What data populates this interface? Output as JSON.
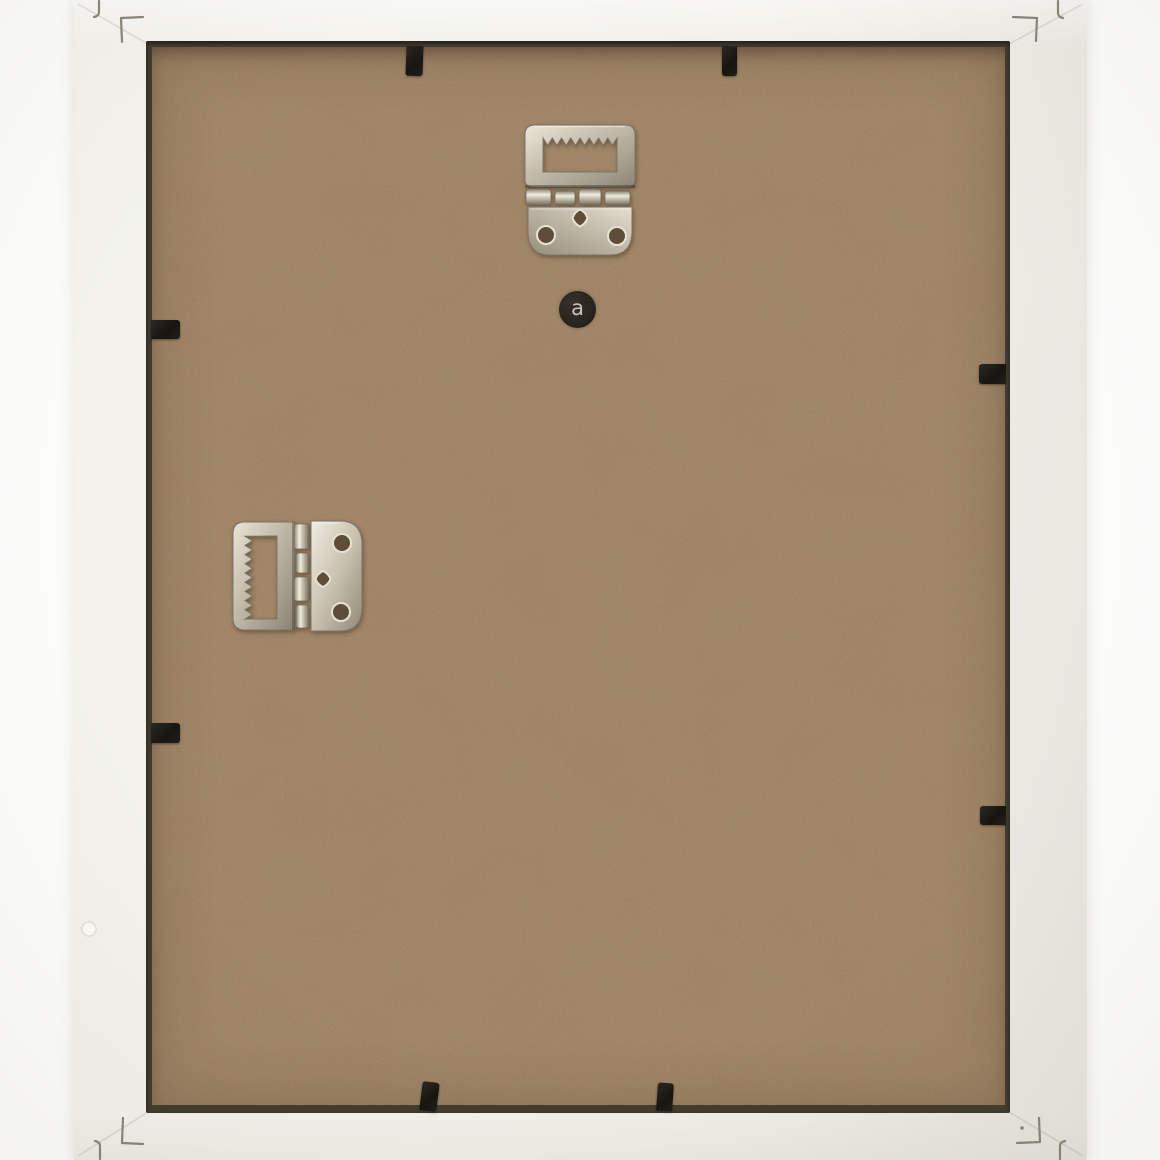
{
  "window": {
    "title": "Back of a white picture frame"
  },
  "scene": {
    "type": "product-photo",
    "subject": "Rear view of a white wooden picture frame with brown MDF backing board",
    "background_color": "#fdfdfc",
    "frame": {
      "name": "white wooden frame",
      "color": "#f1f0ea"
    },
    "backing_board": {
      "name": "MDF backing board",
      "color": "#9f8263",
      "recess_color": "#423c30"
    },
    "hardware": {
      "hangers": [
        {
          "name": "sawtooth hinge hanger",
          "position": "top center",
          "orientation": "vertical",
          "finish": "nickel-plated steel"
        },
        {
          "name": "sawtooth hinge hanger",
          "position": "left middle",
          "orientation": "rotated 90 degrees",
          "finish": "nickel-plated steel"
        }
      ],
      "clips": {
        "name": "black metal retaining clips",
        "count": 8,
        "color": "#1c1a17"
      },
      "corner_marks": {
        "name": "v-nail corner fastener marks",
        "count": 4,
        "color": "#8b8679"
      }
    },
    "stamp": {
      "name": "maker logo stamp",
      "letter": "a",
      "circle_color": "#2b2722",
      "letter_color": "#d5d0c6"
    }
  }
}
